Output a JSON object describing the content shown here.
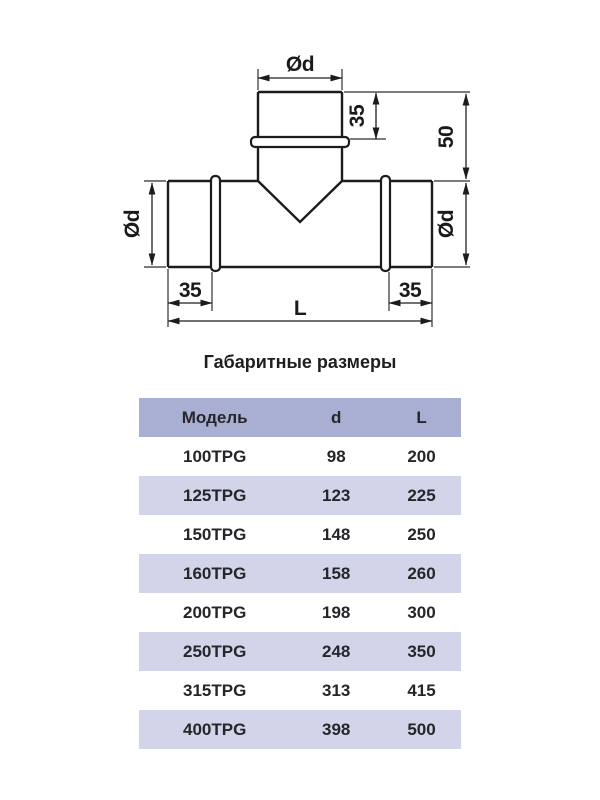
{
  "diagram": {
    "labels": {
      "top_diameter": "Ød",
      "branch_socket_depth": "35",
      "branch_height": "50",
      "left_diameter": "Ød",
      "right_diameter": "Ød",
      "left_socket_depth": "35",
      "right_socket_depth": "35",
      "total_length": "L"
    },
    "line_color": "#1c1c1c"
  },
  "table": {
    "title": "Габаритные размеры",
    "columns": [
      "Модель",
      "d",
      "L"
    ],
    "rows": [
      {
        "model": "100TPG",
        "d": "98",
        "L": "200"
      },
      {
        "model": "125TPG",
        "d": "123",
        "L": "225"
      },
      {
        "model": "150TPG",
        "d": "148",
        "L": "250"
      },
      {
        "model": "160TPG",
        "d": "158",
        "L": "260"
      },
      {
        "model": "200TPG",
        "d": "198",
        "L": "300"
      },
      {
        "model": "250TPG",
        "d": "248",
        "L": "350"
      },
      {
        "model": "315TPG",
        "d": "313",
        "L": "415"
      },
      {
        "model": "400TPG",
        "d": "398",
        "L": "500"
      }
    ],
    "colors": {
      "header_bg": "#a9afd3",
      "stripe_bg": "#d2d5e9",
      "row_bg": "#ffffff",
      "text": "#26262a"
    }
  }
}
